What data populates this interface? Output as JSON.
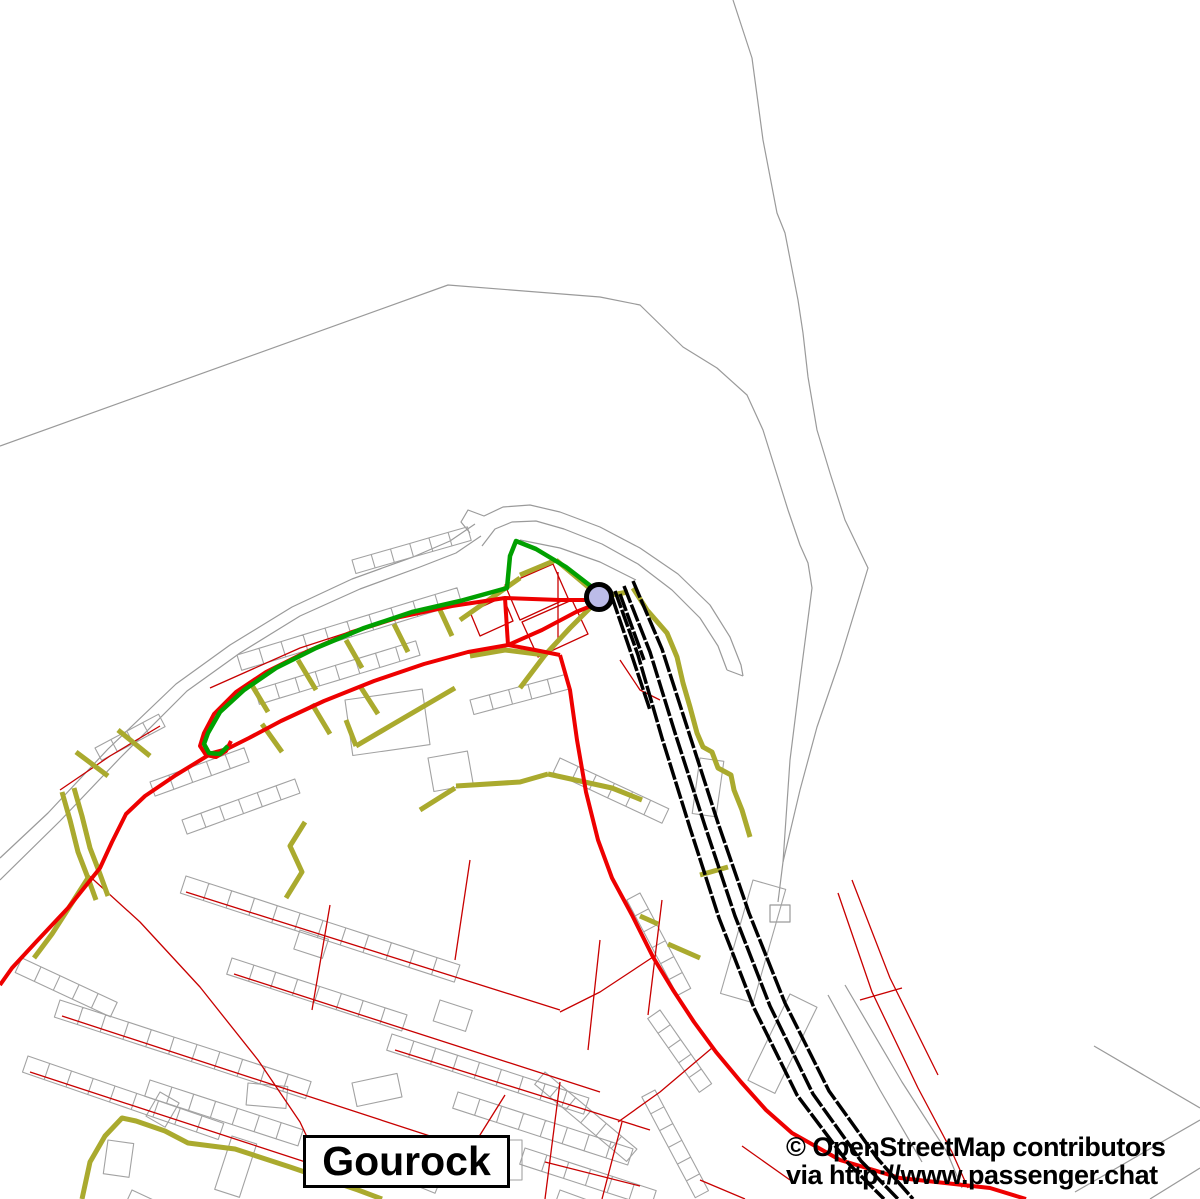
{
  "map": {
    "place_label": "Gourock",
    "attribution_line1": "© OpenStreetMap contributors",
    "attribution_line2": "via http://www.passenger.chat",
    "marker": {
      "cx": 599,
      "cy": 597,
      "r": 12.5,
      "fill": "#bcbce8",
      "stroke": "#000000",
      "stroke_width": 5
    },
    "colors": {
      "sea_boundary": "#9a9a9a",
      "coastline": "#9a9a9a",
      "building": "#a2a2a2",
      "road_minor": "#c80000",
      "road_major": "#ee0000",
      "path_olive": "#aaaa2e",
      "route_green": "#00a000",
      "railway": "#000000"
    },
    "layers": [
      {
        "name": "sea-boundaries",
        "color": "#9a9a9a",
        "width": 1.2,
        "fill": "none",
        "paths": [
          "M733,0 L752,58 L763,140 L777,213 L785,233 L798,300 L803,333 L808,377 L817,430 L830,473 L845,520 L868,568 L840,660 L817,727 L800,790 L783,862",
          "M0,446 L448,285 L600,297 L640,305 L683,347 L717,368 L747,395 L763,430 L788,510 L800,545 L808,563 L812,588 L800,680 L790,760 L783,862",
          "M783,862 L778,902",
          "M770,905 L790,905 L790,922 L770,922 Z",
          "M1094,1046 L1200,1108",
          "M1075,1192 L1200,1120",
          "M1150,1199 L1200,1168"
        ]
      },
      {
        "name": "coastline",
        "color": "#9a9a9a",
        "width": 1.2,
        "fill": "none",
        "paths": [
          "M481,536 L456,553 L420,567 L360,589 L300,616 L240,653 L187,691 L120,758 L60,821 L0,880",
          "M475,524 L450,541 L413,557 L352,579 L292,607 L230,645 L176,684 L108,749 L48,813 L0,858",
          "M470,533 L461,522 L468,510 L484,516 L503,507 L530,505 L560,512 L600,527 L640,548 L678,574 L710,605 L730,637 L741,665 L743,676",
          "M482,546 L495,529 L512,522 L536,521 L564,529 L602,544 L638,564 L672,590 L700,618 L718,646 L727,670",
          "M520,540 L560,548 L600,562 L636,580",
          "M828,995 L880,1090 L922,1162",
          "M845,985 L902,1082 L947,1152 L962,1188",
          "M727,670 L743,676"
        ]
      },
      {
        "name": "minor-roads",
        "color": "#c80000",
        "width": 1.3,
        "fill": "none",
        "paths": [
          "M210,688 L300,648 L380,622 L452,602 L505,590",
          "M505,585 L553,564 L568,598 L520,620 Z",
          "M522,622 L572,600 L588,634 L538,657 Z",
          "M470,612 L503,597 L513,621 L480,636 Z",
          "M558,572 L558,640",
          "M186,892 L560,1010",
          "M62,1016 L430,1136",
          "M30,1072 L330,1170",
          "M234,974 L600,1092",
          "M395,1050 L650,1130",
          "M600,940 L588,1050",
          "M662,900 L648,1015",
          "M330,905 L312,1010",
          "M470,860 L455,960",
          "M838,893 L872,992 L918,1088 L952,1152 L968,1188",
          "M852,880 L890,978 L938,1075",
          "M860,1000 L902,988",
          "M85,872 L140,922 L200,987 L258,1060 L300,1122 L330,1186",
          "M60,790 L110,756 L160,726",
          "M653,957 L600,992 L560,1012",
          "M712,1048 L660,1092 L618,1122",
          "M560,1082 L545,1199",
          "M622,1122 L602,1199",
          "M545,1162 L640,1186",
          "M742,1146 L790,1180",
          "M700,1180 L745,1199",
          "M505,1095 L480,1135 L485,1175",
          "M620,660 L640,690 L660,700"
        ]
      },
      {
        "name": "olive-paths",
        "color": "#aaaa2e",
        "width": 5,
        "fill": "none",
        "paths": [
          "M633,588 L647,610 L667,633 L677,657 L683,683 L690,707 L697,733 L703,747 L712,752 L718,768 L731,775 L734,790 L742,810 L750,837",
          "M556,560 L600,597 L628,592",
          "M598,600 L570,628 L545,655 L520,688",
          "M545,655 L505,650 L470,656",
          "M520,575 L556,560",
          "M460,620 L520,578",
          "M250,682 L268,712",
          "M298,660 L316,690",
          "M346,640 L362,668",
          "M394,624 L408,652",
          "M440,610 L452,636",
          "M262,724 L282,752",
          "M312,704 L330,734",
          "M360,686 L378,714",
          "M62,792 L70,820 L78,852 L88,878 L96,900",
          "M74,788 L82,816 L90,848 L100,874 L108,896",
          "M88,878 L70,906 L52,934 L34,958",
          "M76,752 L108,776",
          "M118,730 L150,756",
          "M455,688 L390,726 L356,746",
          "M356,746 L346,720",
          "M456,786 L520,782 L548,774",
          "M548,774 L612,788 L642,800",
          "M420,810 L455,788",
          "M305,822 L290,846 L302,872 L286,898",
          "M640,916 L658,924",
          "M668,944 L700,958",
          "M700,875 L728,867",
          "M82,1199 L90,1162 L105,1136 L122,1118 L136,1121 L165,1131 L188,1143 L235,1149 L290,1167 L358,1190 L382,1199"
        ]
      },
      {
        "name": "major-roads",
        "color": "#ee0000",
        "width": 4,
        "fill": "none",
        "paths": [
          "M606,600 L560,600 L505,598 L452,606 L400,617 L352,632 L306,652 L266,672 L236,692 L214,714 L204,733 L200,746 L206,755 L216,757 L226,751 L231,741",
          "M508,645 L468,652 L424,664 L374,681 L324,701 L281,721 L249,738 L227,749 L212,753",
          "M505,598 L508,645",
          "M508,645 L542,630 L576,612 L606,600",
          "M508,645 L535,650 L560,655",
          "M560,655 L570,690 L577,740 L586,792 L598,840 L612,878 L632,915 L653,957 L673,990 L694,1022 L716,1052 L741,1082 L766,1110 L792,1133 L840,1160 L900,1178 L990,1188 L1026,1199",
          "M212,753 L176,775 L145,796 L126,814 L112,842 L100,868 L68,908 L36,942 L12,968 L0,985"
        ]
      },
      {
        "name": "green-route",
        "color": "#00a000",
        "width": 4.5,
        "fill": "none",
        "paths": [
          "M601,594 L566,567 L536,549 L516,541 L510,556 L507,588 L460,601 L412,612 L364,628 L316,648 L276,668 L244,690 L220,712 L208,733 L204,744 L209,753 L220,754 L228,746"
        ]
      },
      {
        "name": "railway",
        "color": "#000000",
        "width": 3.5,
        "fill": "none",
        "dash": "18 2",
        "paths": [
          "M615,591 L638,655 L662,738 L690,828 L719,918 L754,1008 L797,1095 L848,1163 L884,1199",
          "M624,586 L650,652 L676,736 L705,826 L735,916 L770,1006 L813,1094 L861,1161 L898,1199",
          "M633,581 L662,649 L689,733 L718,823 L749,913 L785,1003 L829,1091 L877,1158 L913,1199",
          "M612,597 L630,650 L650,710",
          "M620,594 L644,660"
        ]
      }
    ],
    "building_rows": [
      {
        "x": 237,
        "y": 655,
        "angle": -17,
        "count": 10,
        "w": 23,
        "h": 16
      },
      {
        "x": 255,
        "y": 690,
        "angle": -17,
        "count": 8,
        "w": 21,
        "h": 15
      },
      {
        "x": 352,
        "y": 560,
        "angle": -16,
        "count": 6,
        "w": 20,
        "h": 14
      },
      {
        "x": 95,
        "y": 748,
        "angle": -28,
        "count": 4,
        "w": 18,
        "h": 14
      },
      {
        "x": 150,
        "y": 782,
        "angle": -20,
        "count": 5,
        "w": 20,
        "h": 15
      },
      {
        "x": 182,
        "y": 820,
        "angle": -20,
        "count": 6,
        "w": 20,
        "h": 15
      },
      {
        "x": 186,
        "y": 876,
        "angle": 18,
        "count": 12,
        "w": 24,
        "h": 18
      },
      {
        "x": 60,
        "y": 1000,
        "angle": 18,
        "count": 11,
        "w": 24,
        "h": 18
      },
      {
        "x": 28,
        "y": 1056,
        "angle": 19,
        "count": 9,
        "w": 23,
        "h": 17
      },
      {
        "x": 150,
        "y": 1080,
        "angle": 18,
        "count": 7,
        "w": 23,
        "h": 17
      },
      {
        "x": 232,
        "y": 958,
        "angle": 18,
        "count": 8,
        "w": 23,
        "h": 17
      },
      {
        "x": 392,
        "y": 1034,
        "angle": 18,
        "count": 9,
        "w": 23,
        "h": 17
      },
      {
        "x": 458,
        "y": 1092,
        "angle": 18,
        "count": 8,
        "w": 23,
        "h": 17
      },
      {
        "x": 525,
        "y": 1148,
        "angle": 18,
        "count": 6,
        "w": 23,
        "h": 17
      },
      {
        "x": 22,
        "y": 958,
        "angle": 25,
        "count": 5,
        "w": 21,
        "h": 16
      },
      {
        "x": 640,
        "y": 893,
        "angle": 62,
        "count": 6,
        "w": 18,
        "h": 15
      },
      {
        "x": 545,
        "y": 1072,
        "angle": 40,
        "count": 6,
        "w": 20,
        "h": 16
      },
      {
        "x": 660,
        "y": 1010,
        "angle": 55,
        "count": 5,
        "w": 18,
        "h": 15
      },
      {
        "x": 560,
        "y": 758,
        "angle": 25,
        "count": 6,
        "w": 20,
        "h": 16
      },
      {
        "x": 470,
        "y": 700,
        "angle": -15,
        "count": 5,
        "w": 20,
        "h": 15
      },
      {
        "x": 655,
        "y": 1090,
        "angle": 62,
        "count": 6,
        "w": 19,
        "h": 15
      }
    ],
    "building_rects": [
      {
        "x": 345,
        "y": 700,
        "w": 78,
        "h": 56,
        "angle": -8
      },
      {
        "x": 753,
        "y": 880,
        "w": 34,
        "h": 118,
        "angle": 16
      },
      {
        "x": 790,
        "y": 994,
        "w": 30,
        "h": 96,
        "angle": 26
      },
      {
        "x": 700,
        "y": 758,
        "w": 24,
        "h": 56,
        "angle": 8
      },
      {
        "x": 508,
        "y": 1140,
        "w": 14,
        "h": 40,
        "angle": 0
      },
      {
        "x": 428,
        "y": 758,
        "w": 40,
        "h": 34,
        "angle": -10
      },
      {
        "x": 108,
        "y": 1140,
        "w": 26,
        "h": 34,
        "angle": 8
      },
      {
        "x": 160,
        "y": 1092,
        "w": 22,
        "h": 28,
        "angle": 30
      },
      {
        "x": 248,
        "y": 1083,
        "w": 40,
        "h": 22,
        "angle": 5
      },
      {
        "x": 352,
        "y": 1083,
        "w": 46,
        "h": 24,
        "angle": -12
      },
      {
        "x": 232,
        "y": 1136,
        "w": 26,
        "h": 56,
        "angle": 18
      },
      {
        "x": 398,
        "y": 1146,
        "w": 52,
        "h": 30,
        "angle": 22
      },
      {
        "x": 560,
        "y": 1190,
        "w": 40,
        "h": 20,
        "angle": 20
      },
      {
        "x": 132,
        "y": 1190,
        "w": 30,
        "h": 16,
        "angle": 25
      },
      {
        "x": 440,
        "y": 1000,
        "w": 34,
        "h": 22,
        "angle": 18
      },
      {
        "x": 300,
        "y": 930,
        "w": 30,
        "h": 20,
        "angle": 18
      }
    ]
  }
}
